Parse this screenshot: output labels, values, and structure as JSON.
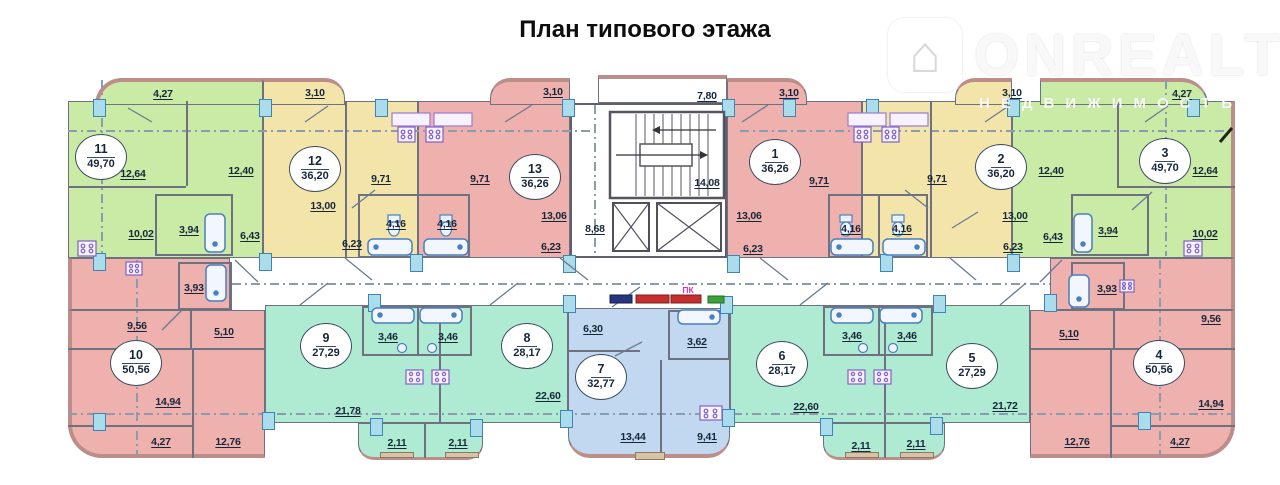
{
  "title": "План типового этажа",
  "watermark": {
    "brand": "ONREALT",
    "subtitle": "НЕДВИЖИМОСТЬ",
    "house_glyph": "⌂"
  },
  "palette": {
    "green": "#c9eba6",
    "yellow": "#f3e5a9",
    "pink": "#efb1ad",
    "teal": "#aeebd2",
    "blue": "#c2d8f0",
    "white": "#ffffff",
    "navy_box": "#27357f",
    "red_box": "#c62f2f",
    "green_box": "#3f9f3f",
    "ink": "#17273a",
    "wall": "#bd8e89",
    "partition": "#6e7280",
    "junction": "#abdcec",
    "fire_label": "#d633b8"
  },
  "core": {
    "corridor_width": "7,80",
    "stairwell": "14,08",
    "lobby": "8,68",
    "fire_cabinet_label": "ПК"
  },
  "apartments": {
    "a11": {
      "number": "11",
      "area": "49,70",
      "rooms": {
        "balcony": "4,27",
        "room1": "12,64",
        "room2": "12,40",
        "kitchen": "10,02",
        "bath": "3,94",
        "hall": "6,43"
      }
    },
    "a12": {
      "number": "12",
      "area": "36,20",
      "rooms": {
        "balcony": "3,10",
        "kitchen": "9,71",
        "room": "13,00",
        "bath": "4,16",
        "hall": "6,23"
      }
    },
    "a13": {
      "number": "13",
      "area": "36,26",
      "rooms": {
        "balcony": "3,10",
        "kitchen": "9,71",
        "room": "13,06",
        "bath": "4,16",
        "hall": "6,23"
      }
    },
    "a1": {
      "number": "1",
      "area": "36,26",
      "rooms": {
        "balcony": "3,10",
        "kitchen": "9,71",
        "room": "13,06",
        "bath": "4,16",
        "hall": "6,23"
      }
    },
    "a2": {
      "number": "2",
      "area": "36,20",
      "rooms": {
        "balcony": "3,10",
        "kitchen": "9,71",
        "room": "13,00",
        "bath": "4,16",
        "hall": "6,23"
      }
    },
    "a3": {
      "number": "3",
      "area": "49,70",
      "rooms": {
        "balcony": "4,27",
        "room1": "12,64",
        "room2": "12,40",
        "kitchen": "10,02",
        "bath": "3,94",
        "hall": "6,43"
      }
    },
    "a10": {
      "number": "10",
      "area": "50,56",
      "rooms": {
        "bath": "3,93",
        "kitchen": "9,56",
        "hall": "5,10",
        "room1": "14,94",
        "room2": "12,76",
        "loggia": "4,27"
      }
    },
    "a9": {
      "number": "9",
      "area": "27,29",
      "rooms": {
        "bath": "3,46",
        "room": "21,78",
        "balcony": "2,11"
      }
    },
    "a8": {
      "number": "8",
      "area": "28,17",
      "rooms": {
        "bath": "3,46",
        "room": "22,60",
        "balcony": "2,11"
      }
    },
    "a7": {
      "number": "7",
      "area": "32,77",
      "rooms": {
        "hall": "6,30",
        "bath": "3,62",
        "room": "13,44",
        "kitchen": "9,41"
      }
    },
    "a6": {
      "number": "6",
      "area": "28,17",
      "rooms": {
        "bath": "3,46",
        "room": "22,60",
        "balcony": "2,11"
      }
    },
    "a5": {
      "number": "5",
      "area": "27,29",
      "rooms": {
        "bath": "3,46",
        "room": "21,72",
        "balcony": "2,11"
      }
    },
    "a4": {
      "number": "4",
      "area": "50,56",
      "rooms": {
        "bath": "3,93",
        "kitchen": "9,56",
        "hall": "5,10",
        "room1": "14,94",
        "room2": "12,76",
        "loggia": "4,27"
      }
    }
  }
}
